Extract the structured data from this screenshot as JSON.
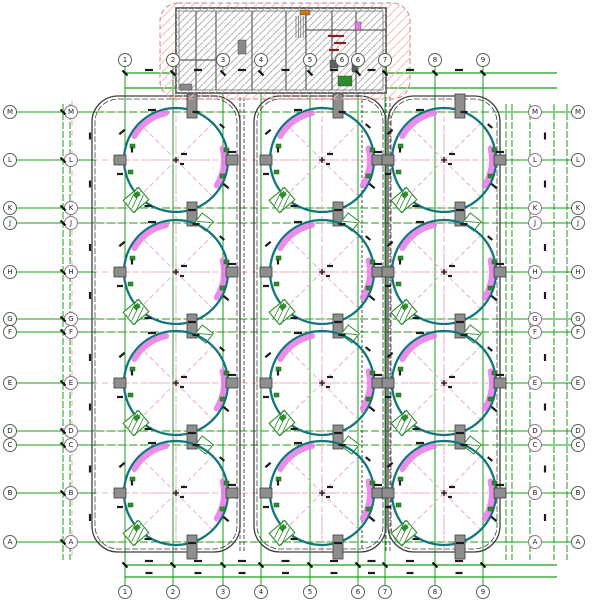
{
  "drawing": {
    "kind": "cad-tank-farm-plan",
    "description": "Engineering plan: 12 circular tanks in 3 columns x 4 rows with column grid bubbles, containment enclosures and a hatched pump-house building at top"
  },
  "colors": {
    "green": "#16a016",
    "green_dark": "#0e7d0e",
    "pink": "#f2aba5",
    "pink_x": "#ecaed2",
    "magenta": "#e879e8",
    "teal": "#13767c",
    "pad_fill": "#8e8e8e",
    "pad_stroke": "#3f3f3f",
    "ink": "#1c1c1c",
    "enclosure": "#3e3e3e",
    "hatch_gray": "#b5b5b5",
    "wall_gray": "#5f5f5f",
    "pink_hatch": "#f2bcbc",
    "dark_red": "#8e1c1c",
    "equip_green": "#2e8b2e"
  },
  "axes": {
    "row_labels": [
      "M",
      "L",
      "K",
      "J",
      "H",
      "G",
      "F",
      "E",
      "D",
      "C",
      "B",
      "A"
    ],
    "row_y": [
      112,
      160,
      208,
      223,
      272,
      319,
      332,
      383,
      431,
      445,
      493,
      542
    ],
    "tank_row_labels": [
      "L",
      "H",
      "E",
      "B"
    ],
    "col_labels": [
      "1",
      "2",
      "3",
      "4",
      "5",
      "6",
      "7",
      "8",
      "9"
    ],
    "col_x": [
      125,
      173,
      223,
      261,
      310,
      358,
      385,
      435,
      483
    ],
    "top_extra_bubble": {
      "x": 342,
      "label": "6"
    },
    "bubble_x_left": [
      10,
      71
    ],
    "bubble_x_right": [
      535,
      578
    ],
    "bubble_y_top": 60,
    "bubble_y_bottom": 592,
    "left_margin_verticals_x": [
      63,
      70
    ],
    "right_margin_verticals_x": [
      506,
      512,
      530,
      554,
      567
    ],
    "top_double_y": [
      73,
      88
    ],
    "bottom_double_y": [
      565,
      577
    ],
    "axis_span_x": [
      125,
      557
    ],
    "margin_span_y": [
      104,
      560
    ]
  },
  "tanks": {
    "col_x": [
      176,
      322,
      444
    ],
    "row_y": [
      160,
      272,
      383,
      493
    ],
    "radius": 52,
    "arc1": {
      "a1": 102,
      "a2": 150,
      "r": 48,
      "w": 6
    },
    "arc2": {
      "a1": -32,
      "a2": 14,
      "r": 48,
      "w": 6
    },
    "side_pads": [
      [
        -56,
        0
      ],
      [
        56,
        0
      ]
    ],
    "row_pad_dx": 16,
    "marks": [
      [
        -54,
        -28,
        -40,
        7
      ],
      [
        -24,
        -50,
        0,
        8
      ],
      [
        20,
        -48,
        0,
        7
      ],
      [
        46,
        -34,
        40,
        6
      ],
      [
        56,
        -8,
        0,
        8
      ],
      [
        50,
        26,
        40,
        7
      ],
      [
        16,
        50,
        0,
        8
      ],
      [
        -28,
        46,
        0,
        7
      ],
      [
        -56,
        14,
        0,
        6
      ],
      [
        -44,
        -10,
        90,
        5
      ],
      [
        8,
        -6,
        0,
        6
      ],
      [
        6,
        4,
        0,
        4
      ]
    ],
    "green_bits": [
      [
        -48,
        10
      ],
      [
        48,
        -12
      ],
      [
        44,
        14
      ],
      [
        -46,
        -16
      ]
    ]
  },
  "enclosures": [
    {
      "x": 92,
      "y": 96,
      "w": 148,
      "h": 456,
      "rx": 26
    },
    {
      "x": 254,
      "y": 96,
      "w": 132,
      "h": 456,
      "rx": 26
    },
    {
      "x": 388,
      "y": 96,
      "w": 112,
      "h": 456,
      "rx": 26
    }
  ],
  "strips": {
    "x": [
      242,
      388
    ],
    "pipe_x": [
      362
    ],
    "y1": 97,
    "y2": 552
  },
  "building": {
    "outline": {
      "x": 160,
      "y": 3,
      "w": 250,
      "h": 96,
      "rx": 18
    },
    "body": {
      "x": 176,
      "y": 8,
      "w": 210,
      "h": 85
    },
    "inner_walls_x": [
      196,
      216,
      252,
      286,
      306,
      332,
      356
    ],
    "inner_walls_h": [
      {
        "y": 30,
        "x1": 306,
        "x2": 386
      },
      {
        "y": 60,
        "x1": 176,
        "x2": 216
      }
    ],
    "grid_cols_through_x": [
      223,
      261,
      310,
      358,
      385
    ],
    "details": [
      {
        "x": 300,
        "y": 10,
        "w": 10,
        "h": 5,
        "c": "#c8781e"
      },
      {
        "x": 330,
        "y": 60,
        "w": 8,
        "h": 8,
        "c": "#5f5f5f"
      },
      {
        "x": 352,
        "y": 62,
        "w": 6,
        "h": 10,
        "c": "#5f5f5f"
      },
      {
        "x": 355,
        "y": 22,
        "w": 6,
        "h": 8,
        "c": "#e879e8"
      },
      {
        "x": 238,
        "y": 40,
        "w": 8,
        "h": 14,
        "c": "#8a8a8a"
      },
      {
        "x": 180,
        "y": 84,
        "w": 12,
        "h": 6,
        "c": "#8a8a8a"
      },
      {
        "x": 338,
        "y": 76,
        "w": 14,
        "h": 10,
        "c": "#2e8b2e"
      }
    ],
    "red_text_marks": [
      {
        "x": 336,
        "y": 36,
        "w": 16
      },
      {
        "x": 340,
        "y": 43,
        "w": 12
      },
      {
        "x": 334,
        "y": 50,
        "w": 10
      }
    ]
  }
}
